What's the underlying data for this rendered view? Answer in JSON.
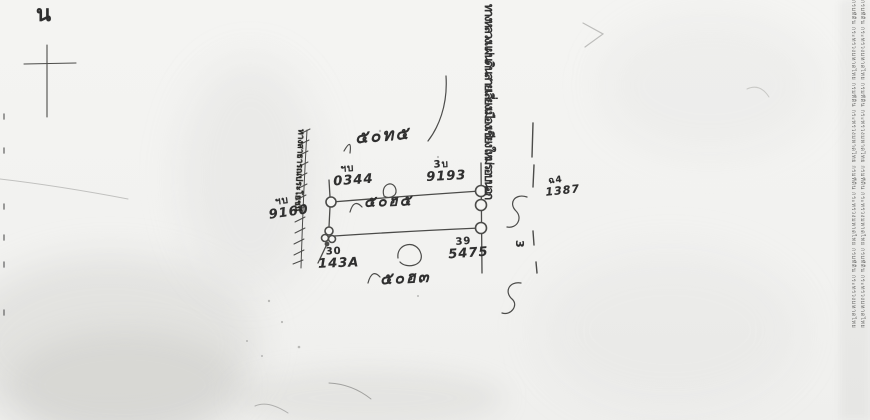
{
  "compass": {
    "north_letter": "น"
  },
  "parcel": {
    "name_top": "๕๐ท๕",
    "name_middle": "๕๐ฮ๕",
    "name_bottom": "๕๐ฮ๓",
    "corner_top_left": {
      "code": "ฯบ",
      "number": "0344"
    },
    "corner_top_right": {
      "code": "3บ",
      "number": "9193"
    },
    "corner_bottom_right": {
      "code": "39",
      "number": "5475"
    },
    "corner_bottom_left": {
      "code": "30",
      "number": "143A"
    },
    "marker_left": {
      "code": "ฯบ",
      "number": "9160"
    }
  },
  "road": {
    "name": "ทางหลวงแผ่นดินสายเลี่ยงเมืองเชียงใหม่รอบนอก",
    "side_mark_code": "ฉ4",
    "side_mark_number": "1387",
    "side_digit": "3"
  },
  "public_way": {
    "name": "ทางสาธารณประโยชน์"
  },
  "edge_text": {
    "column_a": "กรมที่ดิน กระทรวงมหาดไทย กรมที่ดิน กระทรวงมหาดไทย กรมที่ดิน กระทรวงมหาดไทย กรมที่ดิน กระทรวงมหาดไทย",
    "column_b": "กรมที่ดิน กระทรวงมหาดไทย กรมที่ดิน กระทรวงมหาดไทย กรมที่ดิน กระทรวงมหาดไทย กรมที่ดิน กระทรวงมหาดไทย"
  },
  "ink_color": "#2f2f2f"
}
